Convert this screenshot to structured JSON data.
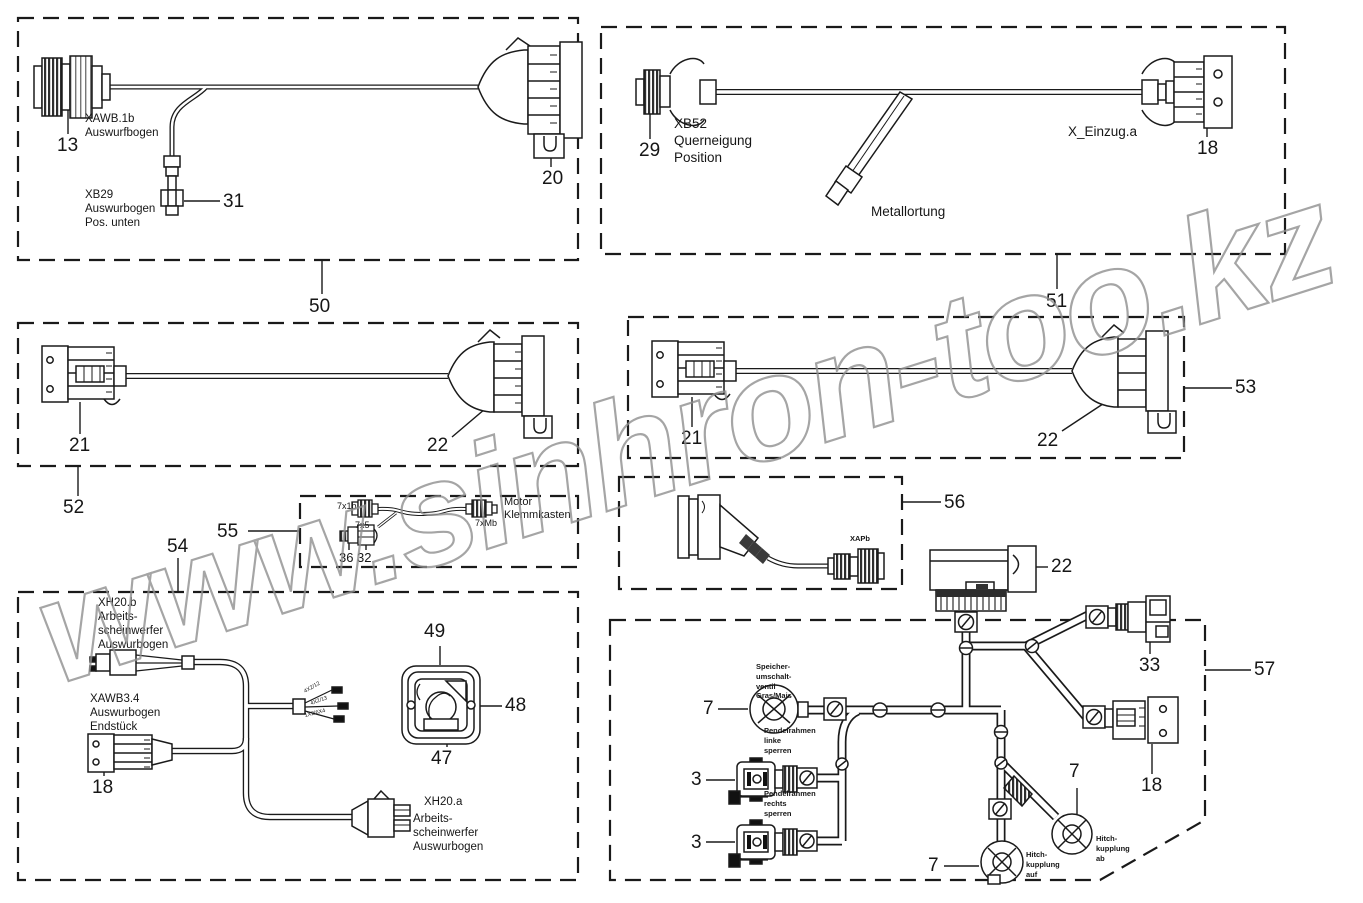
{
  "watermark": {
    "text": "www.sinhron-too.kz",
    "color": "#8f8f8f"
  },
  "boxes": {
    "b50": {
      "num": "50",
      "conn13_name": "XAWB.1b\nAuswurfbogen",
      "ref13": "13",
      "conn31_name": "XB29\nAuswurbogen\nPos. unten",
      "ref31": "31",
      "ref20": "20"
    },
    "b51": {
      "num": "51",
      "conn29_name": "XB52\nQuerneigung\nPosition",
      "ref29": "29",
      "conn18_name": "X_Einzug.a",
      "ref18": "18",
      "probe_name": "Metallortung"
    },
    "b52": {
      "num": "52",
      "ref21": "21",
      "ref22": "22"
    },
    "b53": {
      "num": "53",
      "ref21": "21",
      "ref22": "22"
    },
    "b55": {
      "num": "55",
      "plug_left": "7x1b",
      "plug_right": "7xMb",
      "dest": "Motor\nKlemmkasten",
      "plug_sub": "7x5",
      "ref36": "36",
      "ref32": "32"
    },
    "b56": {
      "num": "56",
      "plug": "XAPb"
    },
    "b54": {
      "num": "54",
      "conn_top_name": "XH20.b\nArbeits-\nscheinwerfer\nAuswurbogen",
      "conn_end_name": "XAWB3.4\nAuswurbogen\nEndstück",
      "ref18": "18",
      "ref49": "49",
      "ref48": "48",
      "ref47": "47",
      "conn_bottom_code": "XH20.a",
      "conn_bottom_name": "Arbeits-\nscheinwerfer\nAuswurbogen",
      "wire1": "4X2/12",
      "wire2": "4X2/13",
      "wire3": "1X2/6X4"
    },
    "b57": {
      "num": "57",
      "ref22": "22",
      "ref33": "33",
      "ref18": "18",
      "valve_speicher": "Speicher-\numschalt-\nventil\nGras/Mais",
      "ref7a": "7",
      "valve_linke": "Pendelrahmen\nlinke\nsperren",
      "ref3a": "3",
      "valve_rechts": "Pendelrahmen\nrechts\nsperren",
      "ref3b": "3",
      "hitch_auf": "Hitch-\nkupplung\nauf",
      "ref7b": "7",
      "hitch_ab": "Hitch-\nkupplung\nab",
      "ref7c": "7"
    }
  }
}
